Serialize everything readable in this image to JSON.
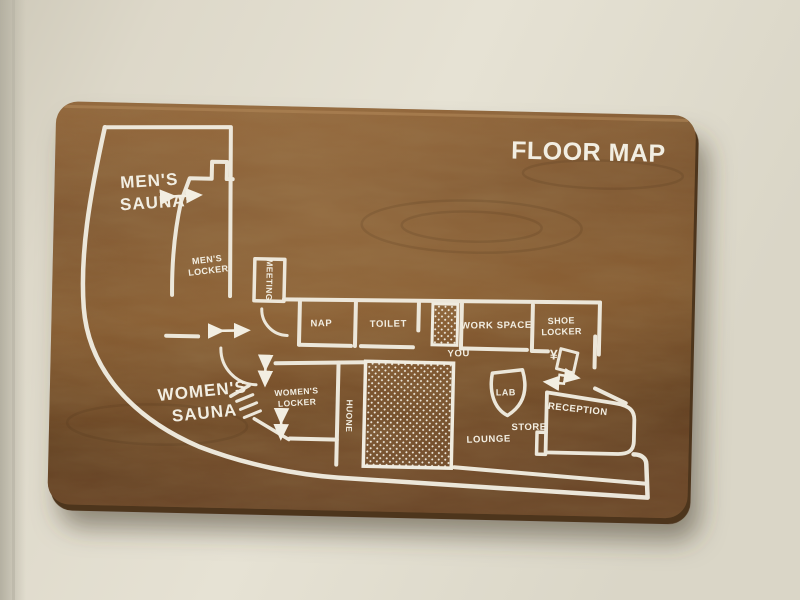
{
  "title": "FLOOR MAP",
  "colors": {
    "wall": "#ded9cb",
    "board_wood": "#7b5634",
    "paint": "#f2eee2"
  },
  "map": {
    "rooms": {
      "mens_sauna": [
        "MEN'S",
        "SAUNA"
      ],
      "mens_locker": [
        "MEN'S",
        "LOCKER"
      ],
      "meeting": "MEETING",
      "nap": "NAP",
      "toilet": "TOILET",
      "work_space": "WORK SPACE",
      "shoe_locker": [
        "SHOE",
        "LOCKER"
      ],
      "womens_sauna": [
        "WOMEN'S",
        "SAUNA"
      ],
      "womens_locker": [
        "WOMEN'S",
        "LOCKER"
      ],
      "huone": "HUONE",
      "lab": "LAB",
      "lounge": "LOUNGE",
      "store": "STORE",
      "reception": "RECEPTION"
    },
    "markers": {
      "you": "YOU",
      "currency": "¥"
    },
    "icons": {
      "two_way_door_arrow": "↔",
      "up_down_door_arrow": "↕",
      "entry_arrow": "→",
      "exit_arrow": "←",
      "stairs": "zigzag",
      "bath_hatch": "dot-mesh",
      "elevator_hatch": "dot-mesh",
      "door_swing": "quarter-arc"
    }
  }
}
